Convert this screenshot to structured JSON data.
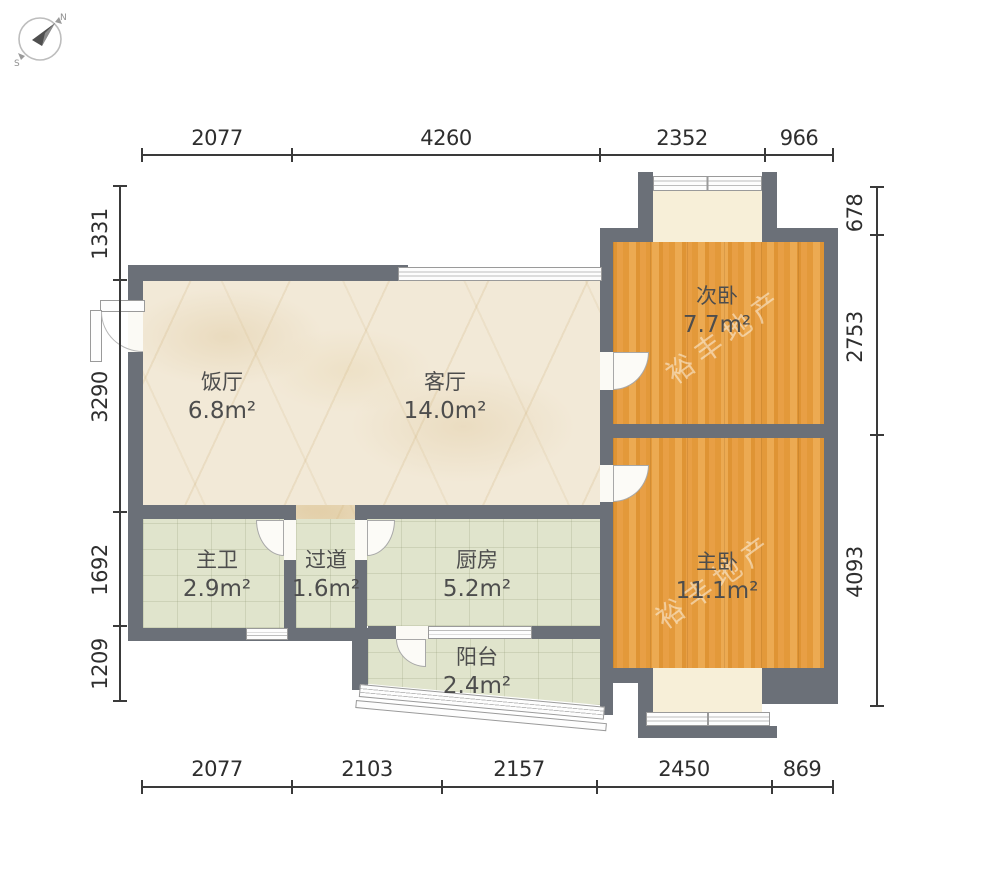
{
  "compass": {
    "north": "N",
    "south": "S"
  },
  "dimensions": {
    "top": [
      "2077",
      "4260",
      "2352",
      "966"
    ],
    "bottom": [
      "2077",
      "2103",
      "2157",
      "2450",
      "869"
    ],
    "left": [
      "1331",
      "3290",
      "1692",
      "1209"
    ],
    "right": [
      "678",
      "2753",
      "4093"
    ]
  },
  "rooms": {
    "dining": {
      "name": "饭厅",
      "area": "6.8m²"
    },
    "living": {
      "name": "客厅",
      "area": "14.0m²"
    },
    "second_bedroom": {
      "name": "次卧",
      "area": "7.7m²"
    },
    "master_bedroom": {
      "name": "主卧",
      "area": "11.1m²"
    },
    "master_bath": {
      "name": "主卫",
      "area": "2.9m²"
    },
    "hallway": {
      "name": "过道",
      "area": "1.6m²"
    },
    "kitchen": {
      "name": "厨房",
      "area": "5.2m²"
    },
    "balcony": {
      "name": "阳台",
      "area": "2.4m²"
    }
  },
  "watermark": {
    "text": "裕丰地产"
  },
  "colors": {
    "wall": "#6b7078",
    "wood_floor": "#e49a3e",
    "marble_floor": "#f2e9d7",
    "tile_floor": "#e0e4cc",
    "bay_interior": "#f7efd8",
    "dimension_text": "#2e2e2e"
  }
}
